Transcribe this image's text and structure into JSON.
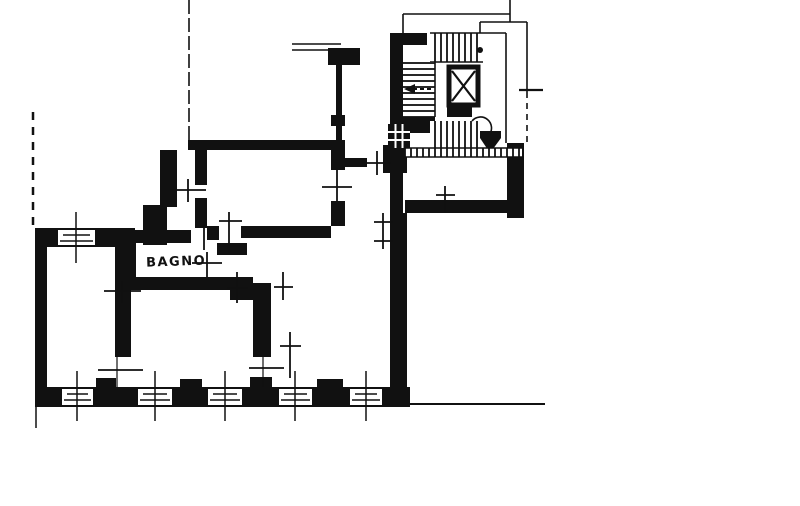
{
  "labels": {
    "bathroom": "BAGNO"
  },
  "colors": {
    "ink": "#111111",
    "paper": "#ffffff"
  }
}
